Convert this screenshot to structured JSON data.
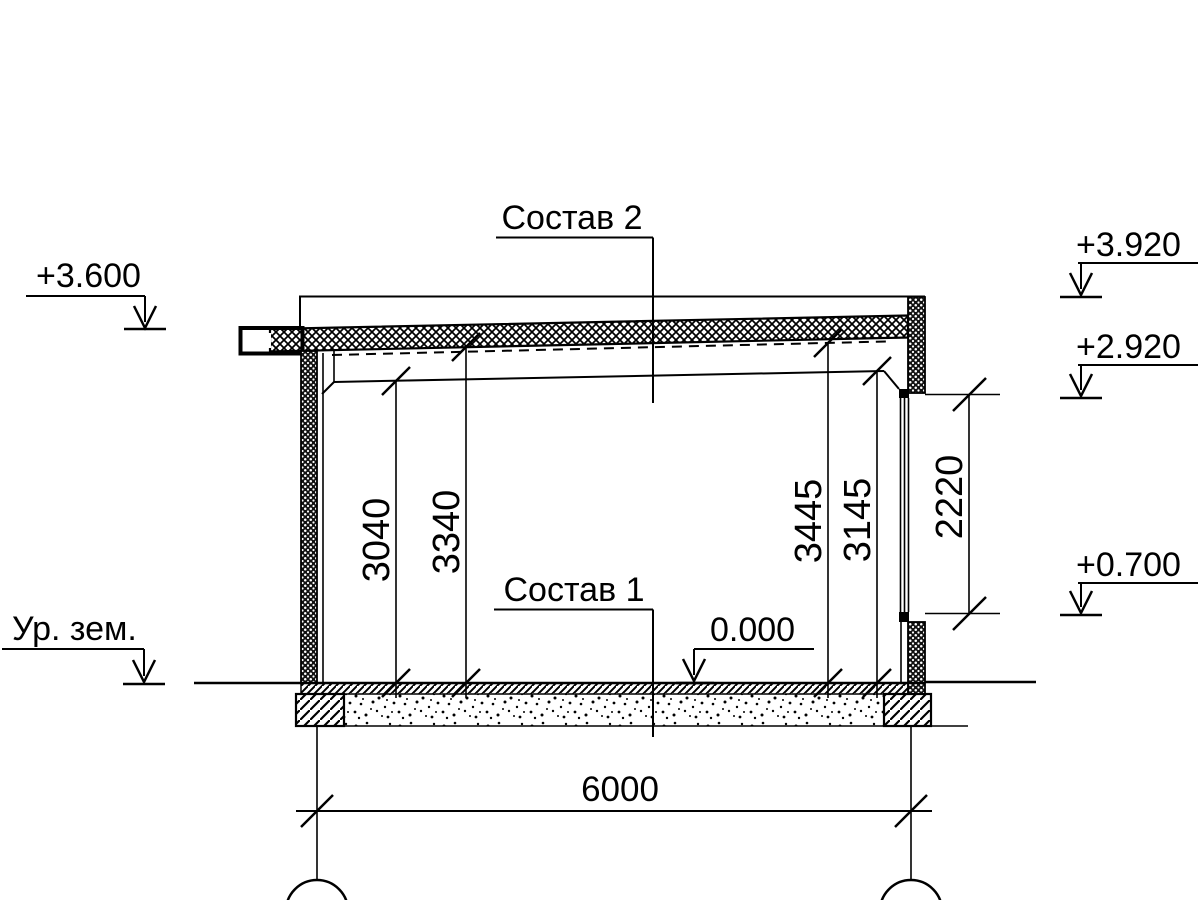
{
  "drawing": {
    "type": "building-section",
    "colors": {
      "ink": "#000000",
      "paper": "#ffffff"
    },
    "labels": {
      "roof_assembly": "Состав 2",
      "floor_assembly": "Состав 1",
      "ground_level": "Ур. зем."
    },
    "elevations": {
      "roof_edge": "+3.600",
      "parapet_top": "+3.920",
      "window_head": "+2.920",
      "window_sill": "+0.700",
      "floor_level": "0.000"
    },
    "dimensions": {
      "ceiling_height_left": "3040",
      "roof_underside_left": "3340",
      "roof_underside_right": "3445",
      "ceiling_height_right": "3145",
      "window_height": "2220",
      "span": "6000"
    }
  }
}
